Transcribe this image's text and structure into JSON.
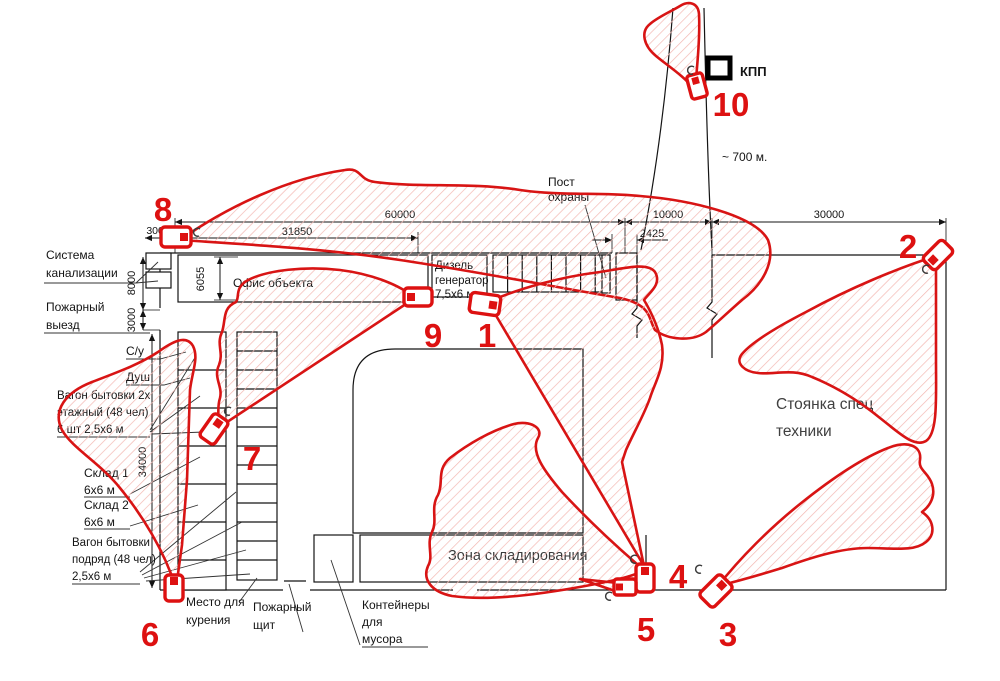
{
  "drawing": {
    "labels": {
      "sewage": [
        "Система",
        "канализации"
      ],
      "fire_exit": [
        "Пожарный",
        "выезд"
      ],
      "wc": "С/у",
      "shower": "Душ",
      "cabin_two_floor": [
        "Вагон бытовки 2х",
        "этажный (48 чел)",
        "6 шт 2,5х6 м"
      ],
      "warehouse1": [
        "Склад 1",
        "6х6 м"
      ],
      "warehouse2": [
        "Склад 2",
        "6х6 м"
      ],
      "cabin_row": [
        "Вагон бытовки",
        "подряд (48 чел)",
        "2,5х6 м"
      ],
      "smoking": [
        "Место для",
        "курения"
      ],
      "fire_shield": [
        "Пожарный",
        "щит"
      ],
      "containers": [
        "Контейнеры",
        "для",
        "мусора"
      ],
      "storage_zone": "Зона складирования",
      "special_parking": [
        "Стоянка спец",
        "техники"
      ],
      "office": "Офис объекта",
      "diesel": [
        "Дизель",
        "генератор",
        "7,5х6 м"
      ],
      "guard_post": [
        "Пост",
        "охраны"
      ],
      "checkpoint": "КПП",
      "distance": "~ 700 м."
    },
    "dimensions": {
      "top_total": "60000",
      "office_width": "31850",
      "left_offset": "3000",
      "entrance_width": "10000",
      "gate_width": "2425",
      "right_width": "30000",
      "sewage_height": "8000",
      "exit_height": "3000",
      "side_height": "34000",
      "office_depth": "6055"
    },
    "cameras": {
      "c1": "1",
      "c2": "2",
      "c3": "3",
      "c4": "4",
      "c5": "5",
      "c6": "6",
      "c7": "7",
      "c8": "8",
      "c9": "9",
      "c10": "10"
    },
    "colors": {
      "camera_red": "#dd1111",
      "hatch_pink": "#f3b8b2",
      "line_black": "#141414"
    }
  }
}
